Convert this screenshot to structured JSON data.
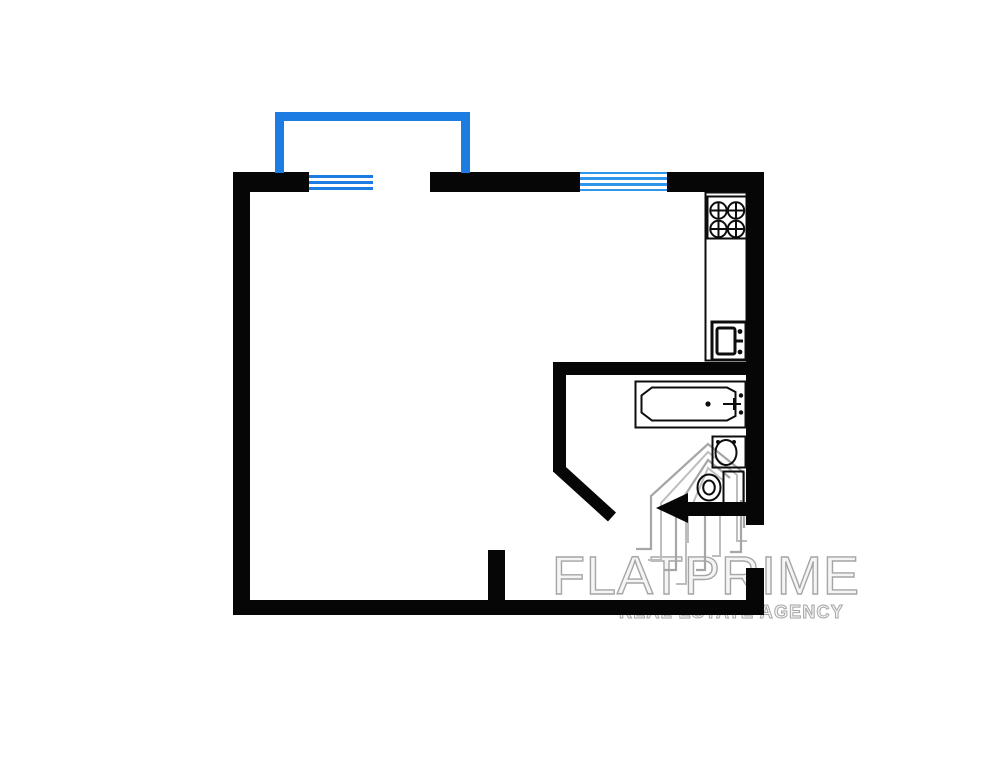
{
  "colors": {
    "background": "#ffffff",
    "wall": "#060606",
    "balcony": "#1c7ce2",
    "window_left": "#1c7ce2",
    "window_right": "#2f95e8",
    "fixture_line": "#0d0d0d",
    "watermark": "#a6a6a6"
  },
  "watermark": {
    "brand": "FLATPRIME",
    "tagline": "REAL ESTATE AGENCY",
    "logo_icon": "building-towers-icon"
  },
  "floorplan": {
    "type": "studio-apartment-plan",
    "features": [
      "balcony-outline",
      "window-left",
      "window-right",
      "entrance-arrow",
      "diagonal-wall",
      "bathroom"
    ],
    "fixture_icons": [
      "stove-burners-icon",
      "kitchen-counter",
      "kitchen-sink-icon",
      "bathtub-icon",
      "washbasin-icon",
      "toilet-icon"
    ]
  }
}
